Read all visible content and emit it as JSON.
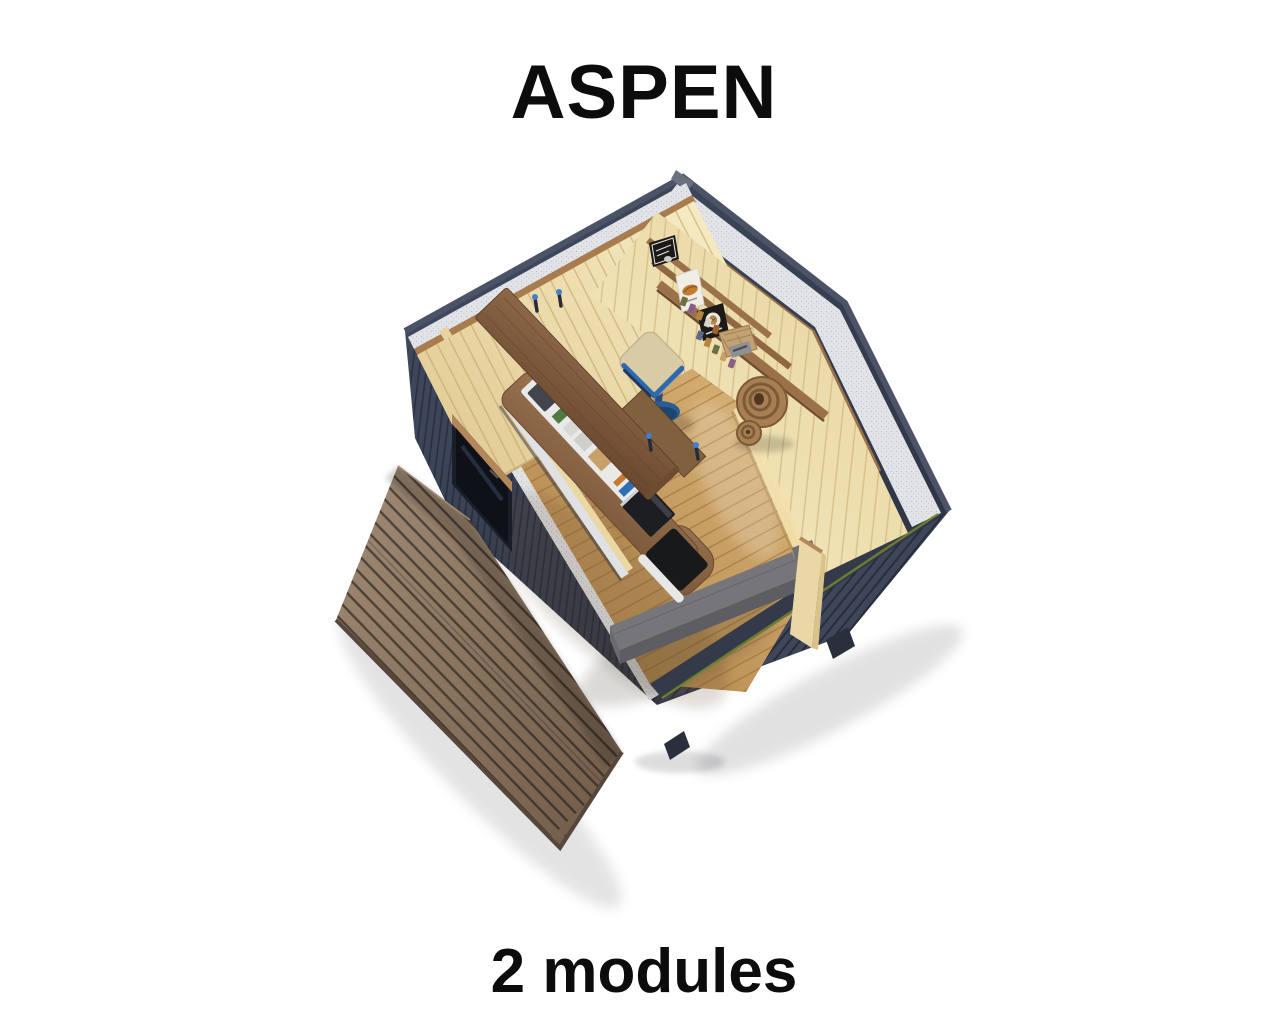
{
  "page": {
    "title": "ASPEN",
    "subtitle": "2 modules"
  },
  "palette": {
    "title_color": "#0c0c0c",
    "wall_dark": "#323848",
    "roof_edge": "#4d5366",
    "insulation": "#e2e3e6",
    "trim_wood": "#a97c4e",
    "pine_wall": "#eedcab",
    "floor_wood": "#c99f63",
    "deck_wood": "#8d7765",
    "bar_wood": "#855f41",
    "counter_white": "#e9e9e8",
    "cabinet_black": "#1b1c1e",
    "bench": "#76767a",
    "bench_front": "#5e5e62",
    "seat_cream": "#d8caa6",
    "stool_blue": "#2b5f9e",
    "shelf_wood": "#9b7149",
    "board_black": "#1b1a18",
    "board_white": "#f1eee7",
    "accent_green": "#77862f"
  }
}
